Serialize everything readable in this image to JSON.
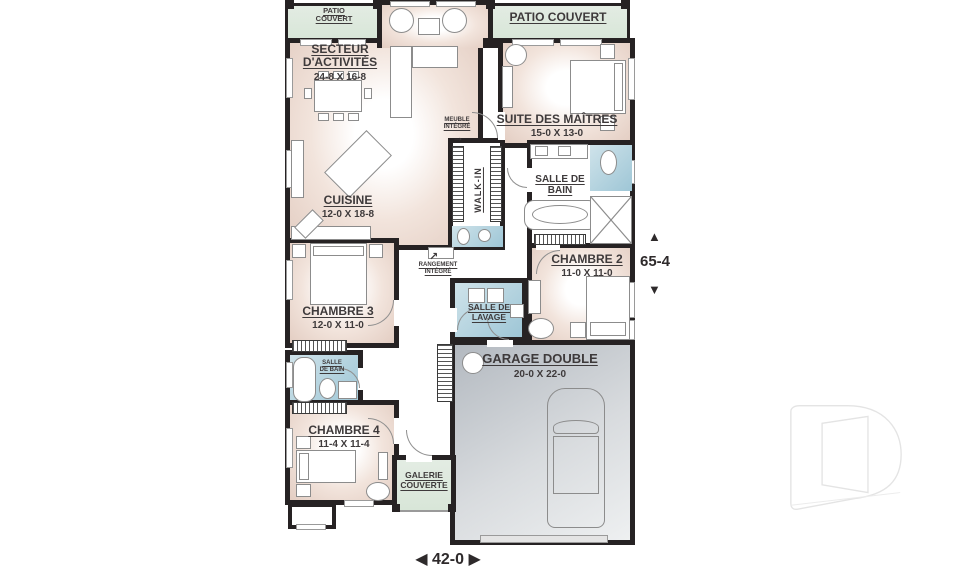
{
  "palette": {
    "wall": "#262223",
    "room_tint": "#e9d5ca",
    "patio_green": "#dce8dc",
    "bath_blue": "#a5c9d8",
    "garage_gray": "#c4c9ce",
    "label_text": "#3e3a3b"
  },
  "rooms": {
    "patio_left": {
      "name_l1": "PATIO",
      "name_l2": "COUVERT"
    },
    "patio_right": {
      "name": "PATIO COUVERT"
    },
    "secteur": {
      "name_l1": "SECTEUR",
      "name_l2": "D'ACTIVITÉS",
      "dims": "24-8 X 16-8"
    },
    "suite_des_maitres": {
      "name": "SUITE DES MAÎTRES",
      "dims": "15-0 X 13-0"
    },
    "cuisine": {
      "name": "CUISINE",
      "dims": "12-0 X 18-8"
    },
    "walk_in": {
      "name": "WALK-IN"
    },
    "salle_de_bain": {
      "name_l1": "SALLE DE",
      "name_l2": "BAIN"
    },
    "chambre_2": {
      "name": "CHAMBRE 2",
      "dims": "11-0 X 11-0"
    },
    "chambre_3": {
      "name": "CHAMBRE 3",
      "dims": "12-0 X 11-0"
    },
    "salle_de_lavage": {
      "name_l1": "SALLE DE",
      "name_l2": "LAVAGE"
    },
    "salle_de_bain_2": {
      "name_l1": "SALLE",
      "name_l2": "DE BAIN"
    },
    "chambre_4": {
      "name": "CHAMBRE 4",
      "dims": "11-4 X 11-4"
    },
    "garage": {
      "name": "GARAGE DOUBLE",
      "dims": "20-0 X 22-0"
    },
    "galerie": {
      "name_l1": "GALERIE",
      "name_l2": "COUVERTE"
    }
  },
  "annotations": {
    "meuble_integre": {
      "l1": "MEUBLE",
      "l2": "INTÉGRÉ"
    },
    "rangement_integre": {
      "l1": "RANGEMENT",
      "l2": "INTÉGRÉ"
    }
  },
  "dimensions": {
    "depth": "65-4",
    "width": "42-0"
  },
  "icons": {
    "arrow_up": "▲",
    "arrow_down": "▼",
    "arrow_left": "◀",
    "arrow_right": "▶",
    "annotation_arrow_right": "→",
    "annotation_arrow_up_right": "↗"
  }
}
